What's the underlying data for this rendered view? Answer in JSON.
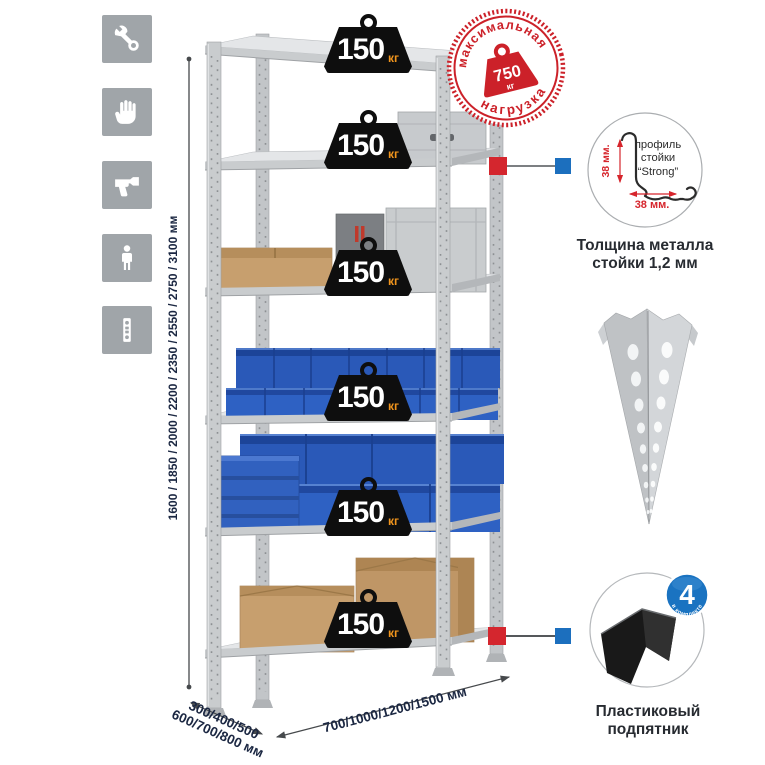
{
  "sidebar": {
    "icons": [
      {
        "name": "wrench-icon"
      },
      {
        "name": "gloves-icon"
      },
      {
        "name": "drill-icon"
      },
      {
        "name": "person-icon"
      },
      {
        "name": "rack-post-icon"
      }
    ]
  },
  "dimensions": {
    "height": "1600 / 1850 / 2000 / 2200 / 2350 / 2550 / 2750 / 3100 мм",
    "depth_line1": "300/400/500",
    "depth_line2": "600/700/800 мм",
    "width": "700/1000/1200/1500 мм"
  },
  "shelf_weight": {
    "value": "150",
    "unit": "кг"
  },
  "stamp": {
    "arc_top": "максимальная",
    "arc_bottom": "нагрузка",
    "value": "750",
    "unit": "кг"
  },
  "profile_detail": {
    "label1": "профиль",
    "label2": "стойки",
    "label3": "“Strong”",
    "dim_v": "38 мм.",
    "dim_h": "38 мм.",
    "caption1": "Толщина металла",
    "caption2": "стойки 1,2 мм"
  },
  "foot_detail": {
    "badge_value": "4",
    "badge_arc": "в комплекте",
    "caption1": "Пластиковый",
    "caption2": "подпятник"
  },
  "colors": {
    "red": "#cc2129",
    "blue": "#1c6fbe",
    "dim_text": "#1b2742"
  }
}
